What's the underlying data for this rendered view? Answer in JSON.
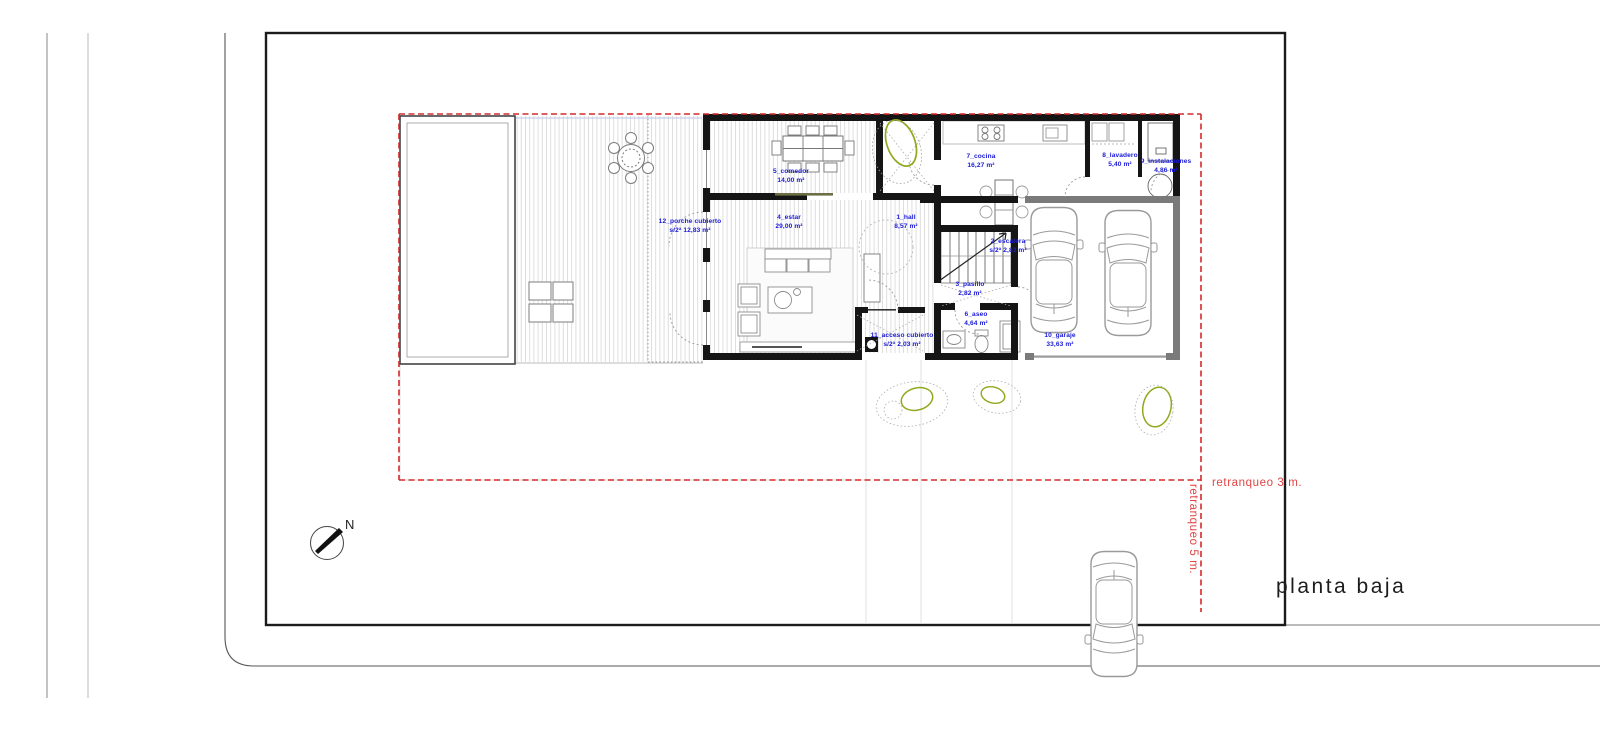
{
  "title": {
    "label": "planta baja"
  },
  "compass": {
    "north_label": "N"
  },
  "setback_labels": {
    "front": "retranqueo   3 m.",
    "side": "retranqueo   5 m."
  },
  "rooms": [
    {
      "name": "1_hall",
      "area": "8,57 m²"
    },
    {
      "name": "2_escalera",
      "area": "s/2ª 2,83 m²"
    },
    {
      "name": "3_pasillo",
      "area": "2,82 m²"
    },
    {
      "name": "4_estar",
      "area": "29,00 m²"
    },
    {
      "name": "5_comedor",
      "area": "14,00 m²"
    },
    {
      "name": "6_aseo",
      "area": "4,64 m²"
    },
    {
      "name": "7_cocina",
      "area": "16,27 m²"
    },
    {
      "name": "8_lavadero",
      "area": "5,40 m²"
    },
    {
      "name": "9_instalaciones",
      "area": "4,86 m²"
    },
    {
      "name": "10_garaje",
      "area": "33,63 m²"
    },
    {
      "name": "11_acceso cubierto",
      "area": "s/2ª 2,03 m²"
    },
    {
      "name": "12_porche cubierto",
      "area": "s/2ª 12,83 m²"
    }
  ],
  "colors": {
    "label_blue": "#1a1ad8",
    "setback_red": "#d42a2a",
    "wall_black": "#151515",
    "garage_gray": "#7a7a7a",
    "tree_green": "#8faa1f"
  }
}
